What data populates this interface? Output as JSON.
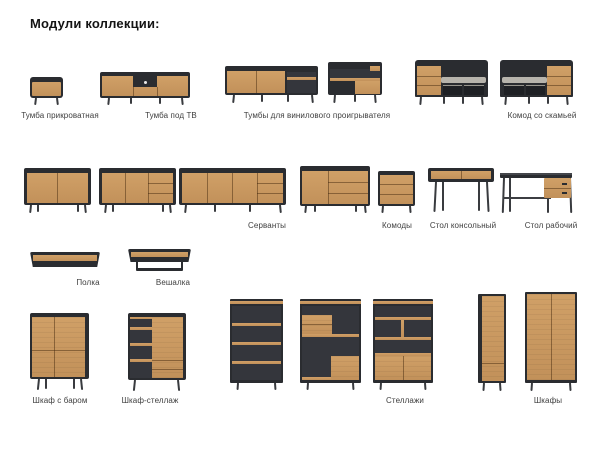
{
  "title": "Модули коллекции:",
  "colors": {
    "wood": "#c2915a",
    "wood-light": "#d0a067",
    "dark": "#2a2c30",
    "interior": "#34363c",
    "opening": "#1e2024",
    "seat": "#b7b4ac",
    "leg": "#393b3f",
    "label": "#3e3e3e",
    "title": "#141414"
  },
  "labels": {
    "bedside": "Тумба прикроватная",
    "tv": "Тумба под ТВ",
    "vinyl": "Тумбы для винилового проигрывателя",
    "bench": "Комод со скамьей",
    "sideboards": "Серванты",
    "dressers": "Комоды",
    "console": "Стол консольный",
    "desk": "Стол рабочий",
    "shelf": "Полка",
    "hanger": "Вешалка",
    "bar": "Шкаф с баром",
    "shelfcab": "Шкаф-стеллаж",
    "shelving": "Стеллажи",
    "wardrobes": "Шкафы"
  }
}
